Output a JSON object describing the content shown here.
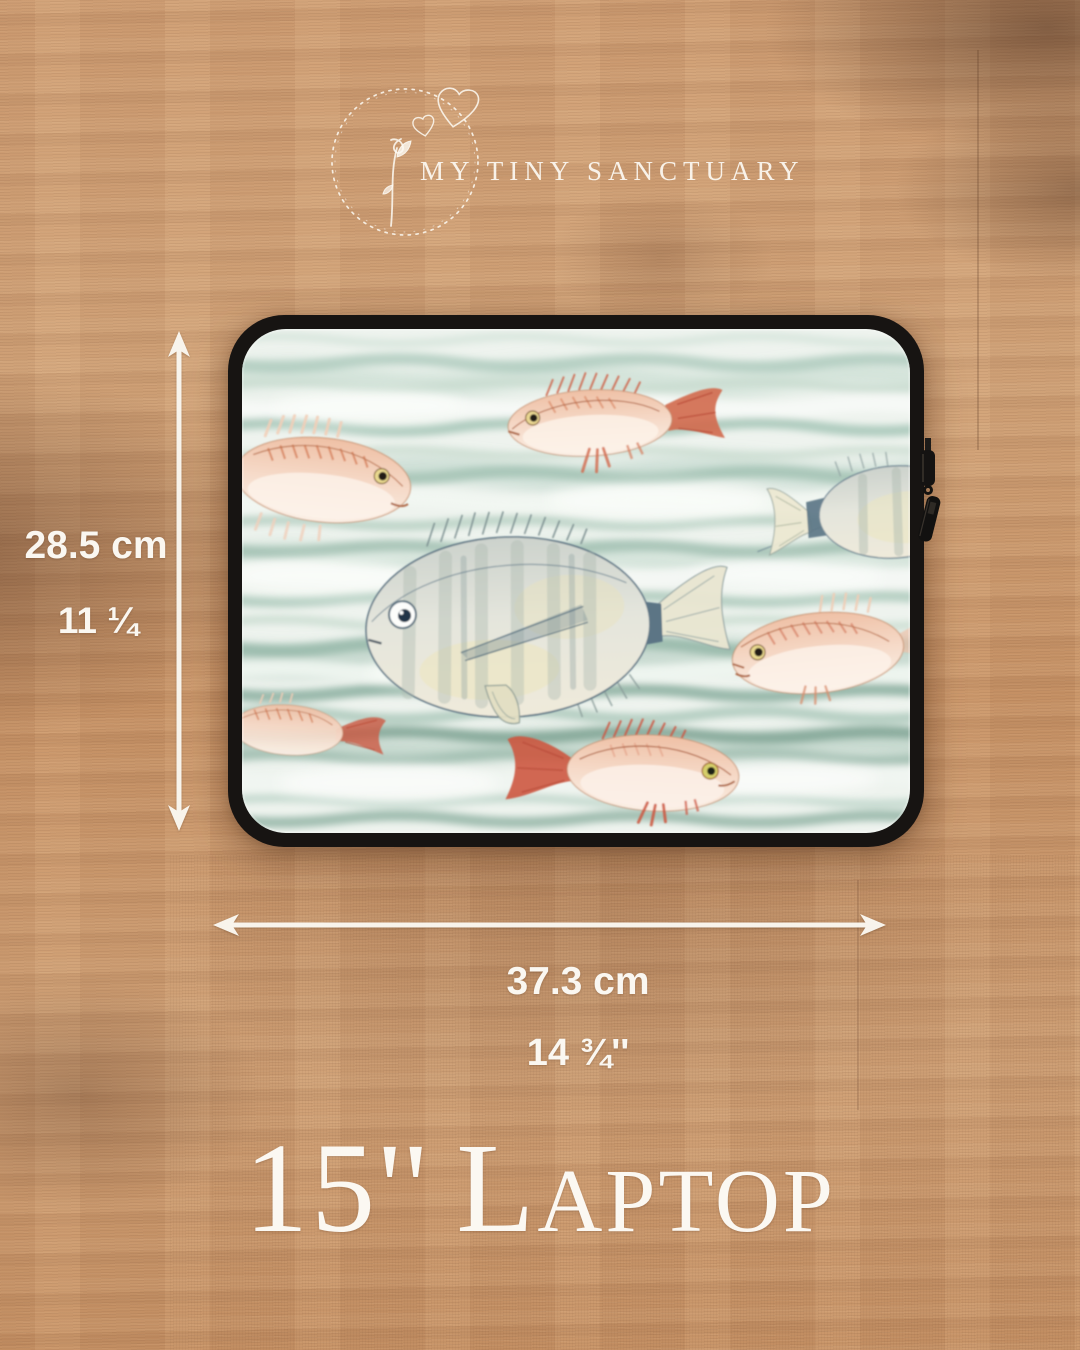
{
  "brand": {
    "name": "MY TINY SANCTUARY",
    "emblem": "wreath-heart-sprout-icon",
    "text_color": "#fcf9f2"
  },
  "product": {
    "size_label": "15''",
    "type_label": "Laptop",
    "description": "laptop sleeve with watercolor fish pattern floating on wooden table"
  },
  "dimensions": {
    "height": {
      "metric": "28.5 cm",
      "imperial": "11 ¼"
    },
    "width": {
      "metric": "37.3 cm",
      "imperial": "14 ¾''"
    }
  },
  "icons": {
    "vertical_arrow": "double-headed-up-down-arrow",
    "horizontal_arrow": "double-headed-left-right-arrow",
    "zipper": "zipper-pull-icon"
  },
  "sleeve": {
    "edge_color": "#171412",
    "fabric_palette": {
      "base": "#edf2ed",
      "wave_light": "#c6dacd",
      "wave_mid": "#a6c5b7",
      "wave_dark": "#7fa394",
      "foam": "#f8faf7"
    },
    "fish": [
      {
        "id": "top-center",
        "facing": "left",
        "colors": "pink body, red-orange tail and fins, yellow eye"
      },
      {
        "id": "upper-left",
        "facing": "right",
        "colors": "salmon body with orange hatch stripes"
      },
      {
        "id": "right-edge-partial",
        "facing": "left",
        "colors": "pale grey-green body, cream forked tail"
      },
      {
        "id": "center-large",
        "facing": "left",
        "colors": "pale grey body, yellow tint, navy tail band, cream tail"
      },
      {
        "id": "mid-right",
        "facing": "left",
        "colors": "salmon body with orange stripes, white belly"
      },
      {
        "id": "bottom-center",
        "facing": "right",
        "colors": "pink body, red tail and dorsal spines, green-yellow eye"
      },
      {
        "id": "lower-left-small",
        "facing": "left",
        "colors": "faded salmon body, red forked tail"
      }
    ]
  },
  "scene": {
    "background": "oak wood tabletop",
    "wood_light": "#d2a378",
    "wood_dark": "#8a5a3c",
    "annotation_color": "#faf7f1"
  }
}
